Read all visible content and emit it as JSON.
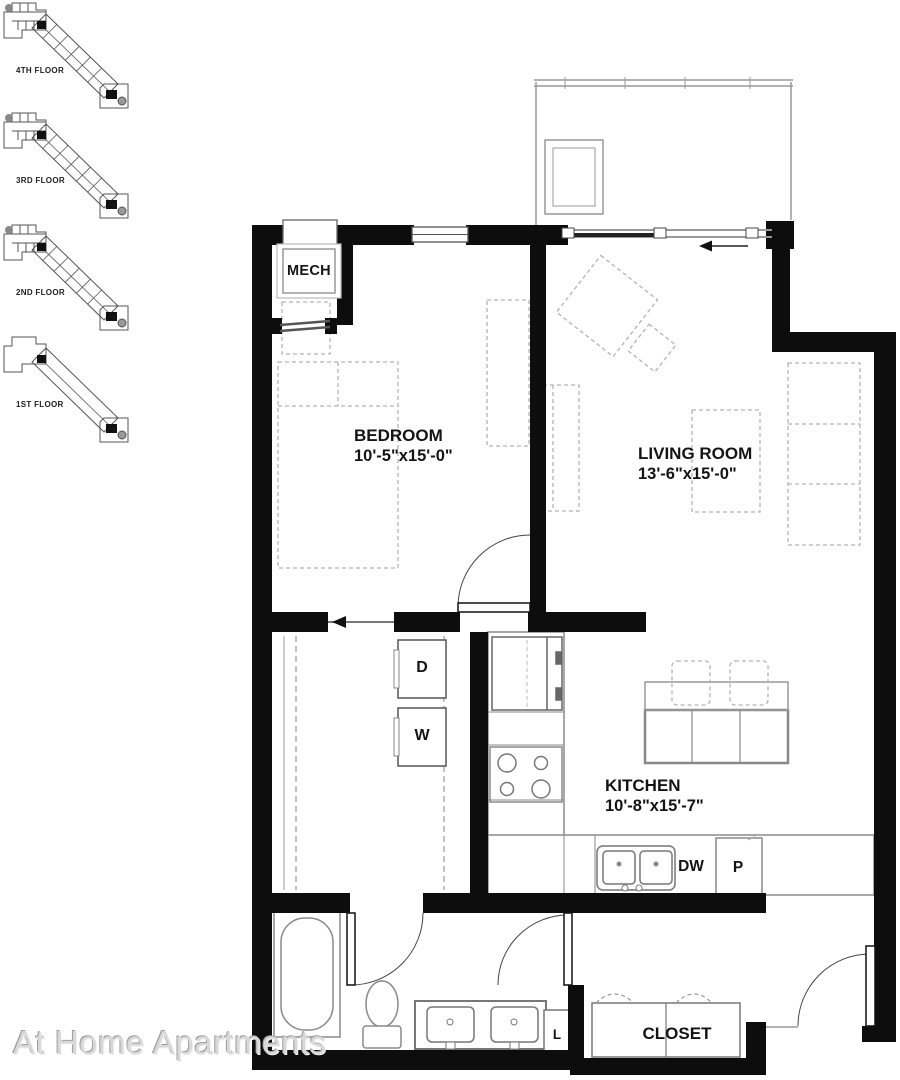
{
  "floor_locators": [
    {
      "label": "4TH FLOOR"
    },
    {
      "label": "3RD FLOOR"
    },
    {
      "label": "2ND FLOOR"
    },
    {
      "label": "1ST FLOOR"
    }
  ],
  "plan": {
    "mech_label": "MECH",
    "bedroom": {
      "name": "BEDROOM",
      "dims": "10'-5\"x15'-0\""
    },
    "living_room": {
      "name": "LIVING ROOM",
      "dims": "13'-6\"x15'-0\""
    },
    "kitchen": {
      "name": "KITCHEN",
      "dims": "10'-8\"x15'-7\""
    },
    "closet_label": "CLOSET",
    "appliances": {
      "dryer": "D",
      "washer": "W",
      "dishwasher": "DW",
      "pantry": "P",
      "linen": "L"
    }
  },
  "watermark": "At Home Apartments",
  "colors": {
    "wall": "#0d0d0d",
    "fixture": "#8a8a8a",
    "furniture": "#b3b3b3",
    "text": "#141414",
    "watermark": "#d8d8d8"
  }
}
